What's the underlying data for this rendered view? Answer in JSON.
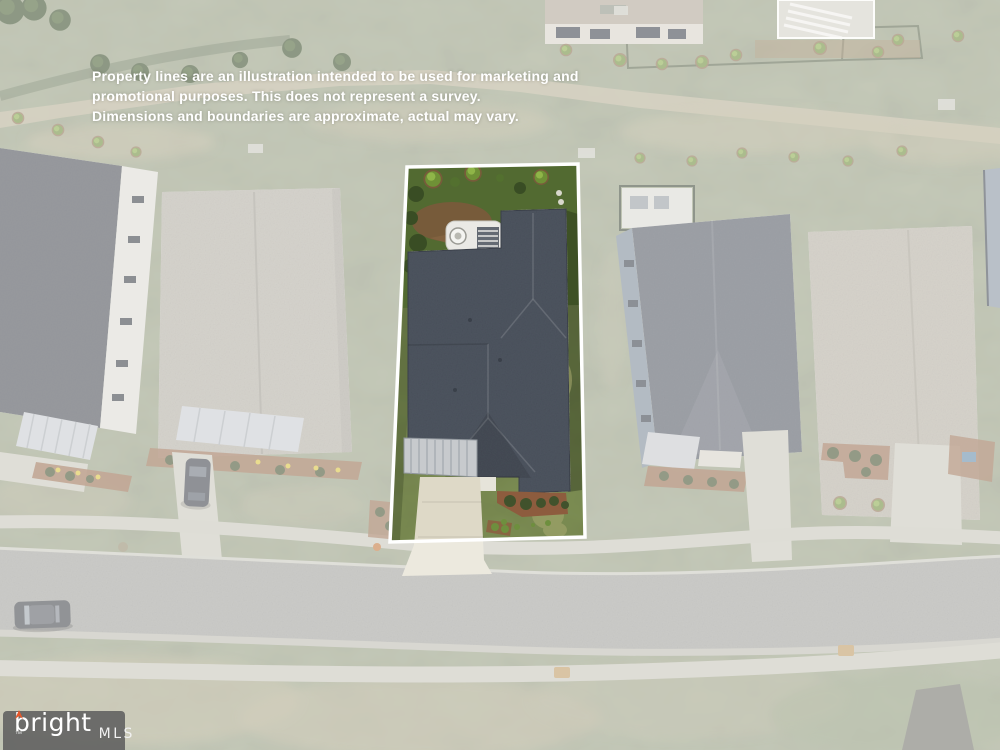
{
  "watermark": {
    "disclaimer_lines": [
      "Property lines are an illustration intended to be used for marketing and",
      "promotional purposes. This does not represent a survey.",
      "Dimensions and boundaries are approximate, actual may vary."
    ]
  },
  "logo": {
    "brand": "bright",
    "trademark": "™",
    "suffix": "MLS"
  },
  "colors": {
    "brand_accent": "#E8582A",
    "property_line": "#FFFFFF",
    "disclaimer_text": "#FFFFFF",
    "logo_background": "rgba(95,95,95,0.88)",
    "wash_overlay": "rgba(255,255,255,0.42)"
  }
}
